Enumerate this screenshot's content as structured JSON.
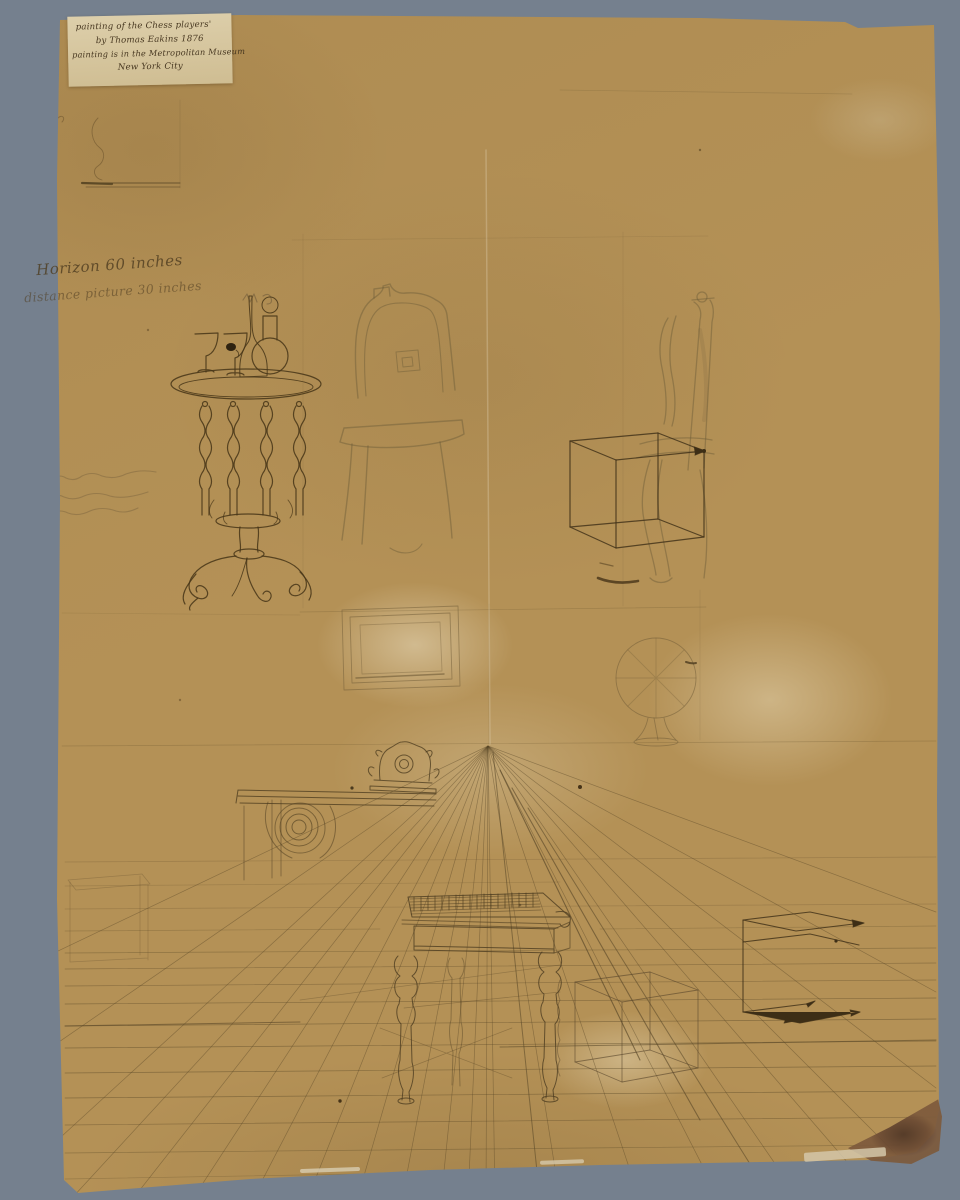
{
  "scene": {
    "description": "Perspective study drawing on tan paper mounted against a gray background",
    "background_color": "#75808e",
    "paper_color": "#b49156",
    "ink_color": "#43341a"
  },
  "label_chip": {
    "line1": "painting of the Chess players'",
    "line2": "by Thomas Eakins  1876",
    "line3": "painting is in the Metropolitan Museum",
    "line4": "New York City"
  },
  "inscriptions": {
    "horizon": "Horizon 60 inches",
    "distance": "distance picture 30 inches"
  },
  "sketch_elements": [
    "pedestal side table with two goblets and decanters",
    "upholstered chair (faint pencil)",
    "side chair with ink perspective cube",
    "picture frame on wall",
    "globe on stand",
    "mantel shelf with clock and scrolled corbel",
    "vanishing point with radiating perspective rays",
    "chess table in perspective with checkerboard top",
    "wireframe perspective boxes",
    "ruled floor grid lines"
  ]
}
